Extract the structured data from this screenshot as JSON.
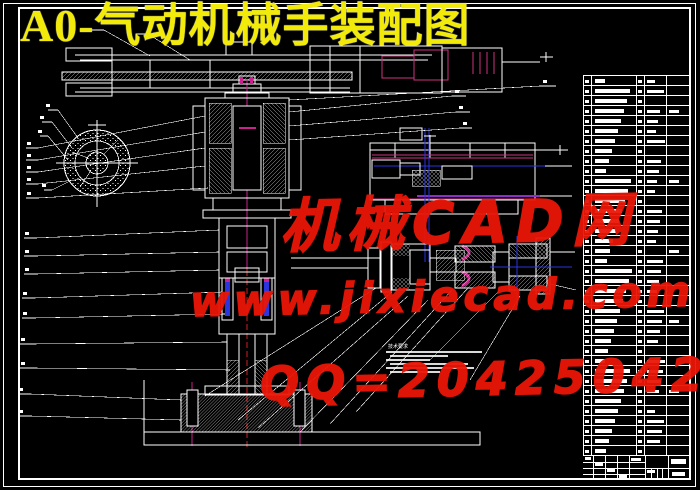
{
  "title": {
    "text": "A0-气动机械手装配图",
    "color": "#f2ea08"
  },
  "watermark": {
    "line1": "机械CAD网",
    "line2": "www.jixiecad.com",
    "line3": "QQ=20425042",
    "color": "#ea1607"
  },
  "technical_notes": {
    "heading": "技术要求",
    "line_count": 6
  },
  "parts_table": {
    "row_count": 38,
    "column_count": 5
  },
  "drawing": {
    "background": "#000000",
    "line_color": "#ffffff",
    "accent_colors": {
      "pink": "#cc3380",
      "magenta": "#cc2090",
      "purple": "#8b2fc9",
      "blue": "#2a35e0",
      "centerline_red": "#d02020",
      "title_yellow": "#f2ea08",
      "watermark_red": "#ea1607"
    }
  }
}
